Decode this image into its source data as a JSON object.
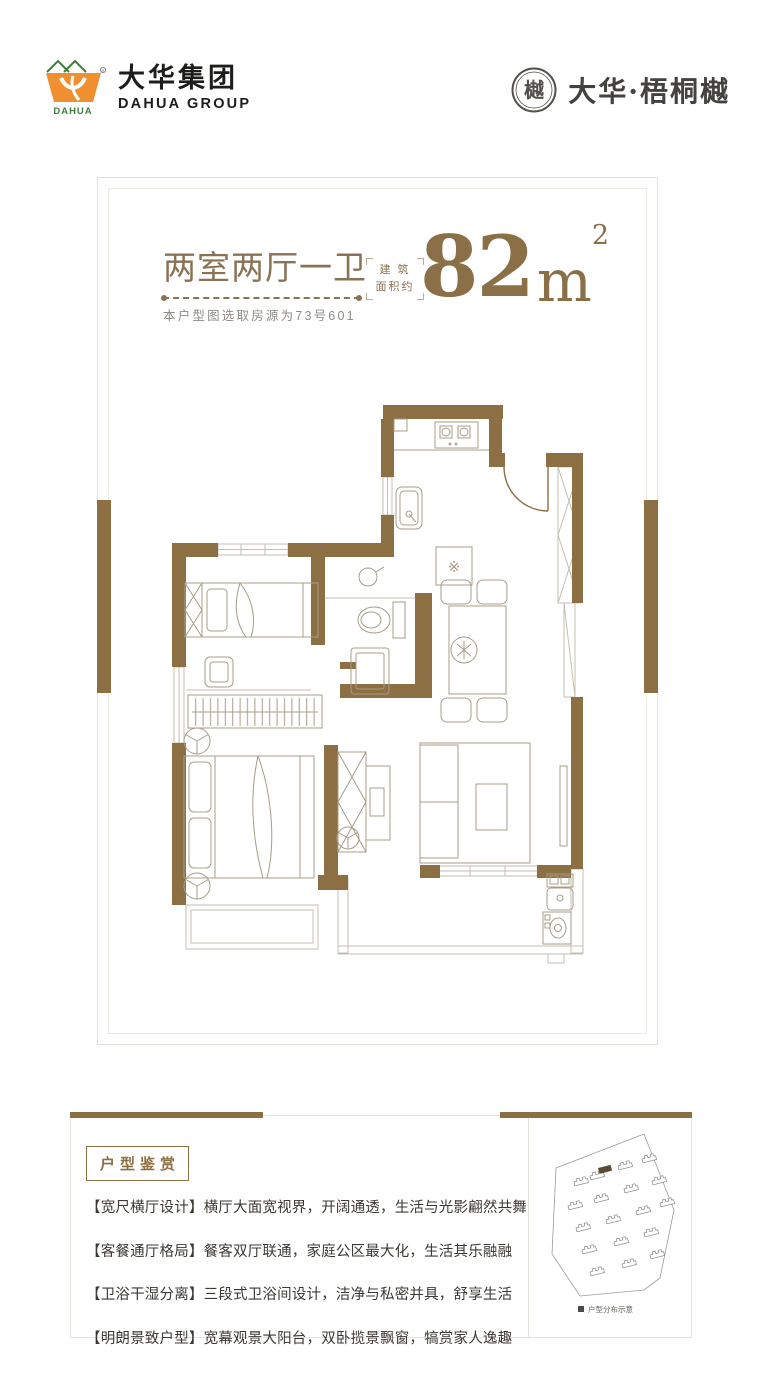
{
  "colors": {
    "wall_brown": "#8C7044",
    "title_brown": "#8A7254",
    "area_brown": "#8A6F47",
    "logo_orange": "#EF8F2F",
    "logo_green": "#3F7D3C",
    "text_dark": "#3C3934"
  },
  "header": {
    "logo_cn": "大华集团",
    "logo_en": "DAHUA GROUP",
    "logo_icon_text": "DAHUA",
    "brand_name": "大华·梧桐樾",
    "brand_seal_char": "樾"
  },
  "plan": {
    "layout_title": "两室两厅一卫",
    "source_note": "本户型图选取房源为73号601",
    "area_label_line1": "建 筑",
    "area_label_line2": "面积约",
    "area_value": "82",
    "area_unit": "m",
    "area_sup": "2",
    "fridge_symbol": "※"
  },
  "features": {
    "badge": "户型鉴赏",
    "items": [
      "【宽尺横厅设计】横厅大面宽视界，开阔通透，生活与光影翩然共舞",
      "【客餐通厅格局】餐客双厅联通，家庭公区最大化，生活其乐融融",
      "【卫浴干湿分离】三段式卫浴间设计，洁净与私密并具，舒享生活",
      "【明朗景致户型】宽幕观景大阳台，双卧揽景飘窗，犒赏家人逸趣"
    ]
  },
  "siteplan": {
    "legend": "户型分布示意"
  }
}
